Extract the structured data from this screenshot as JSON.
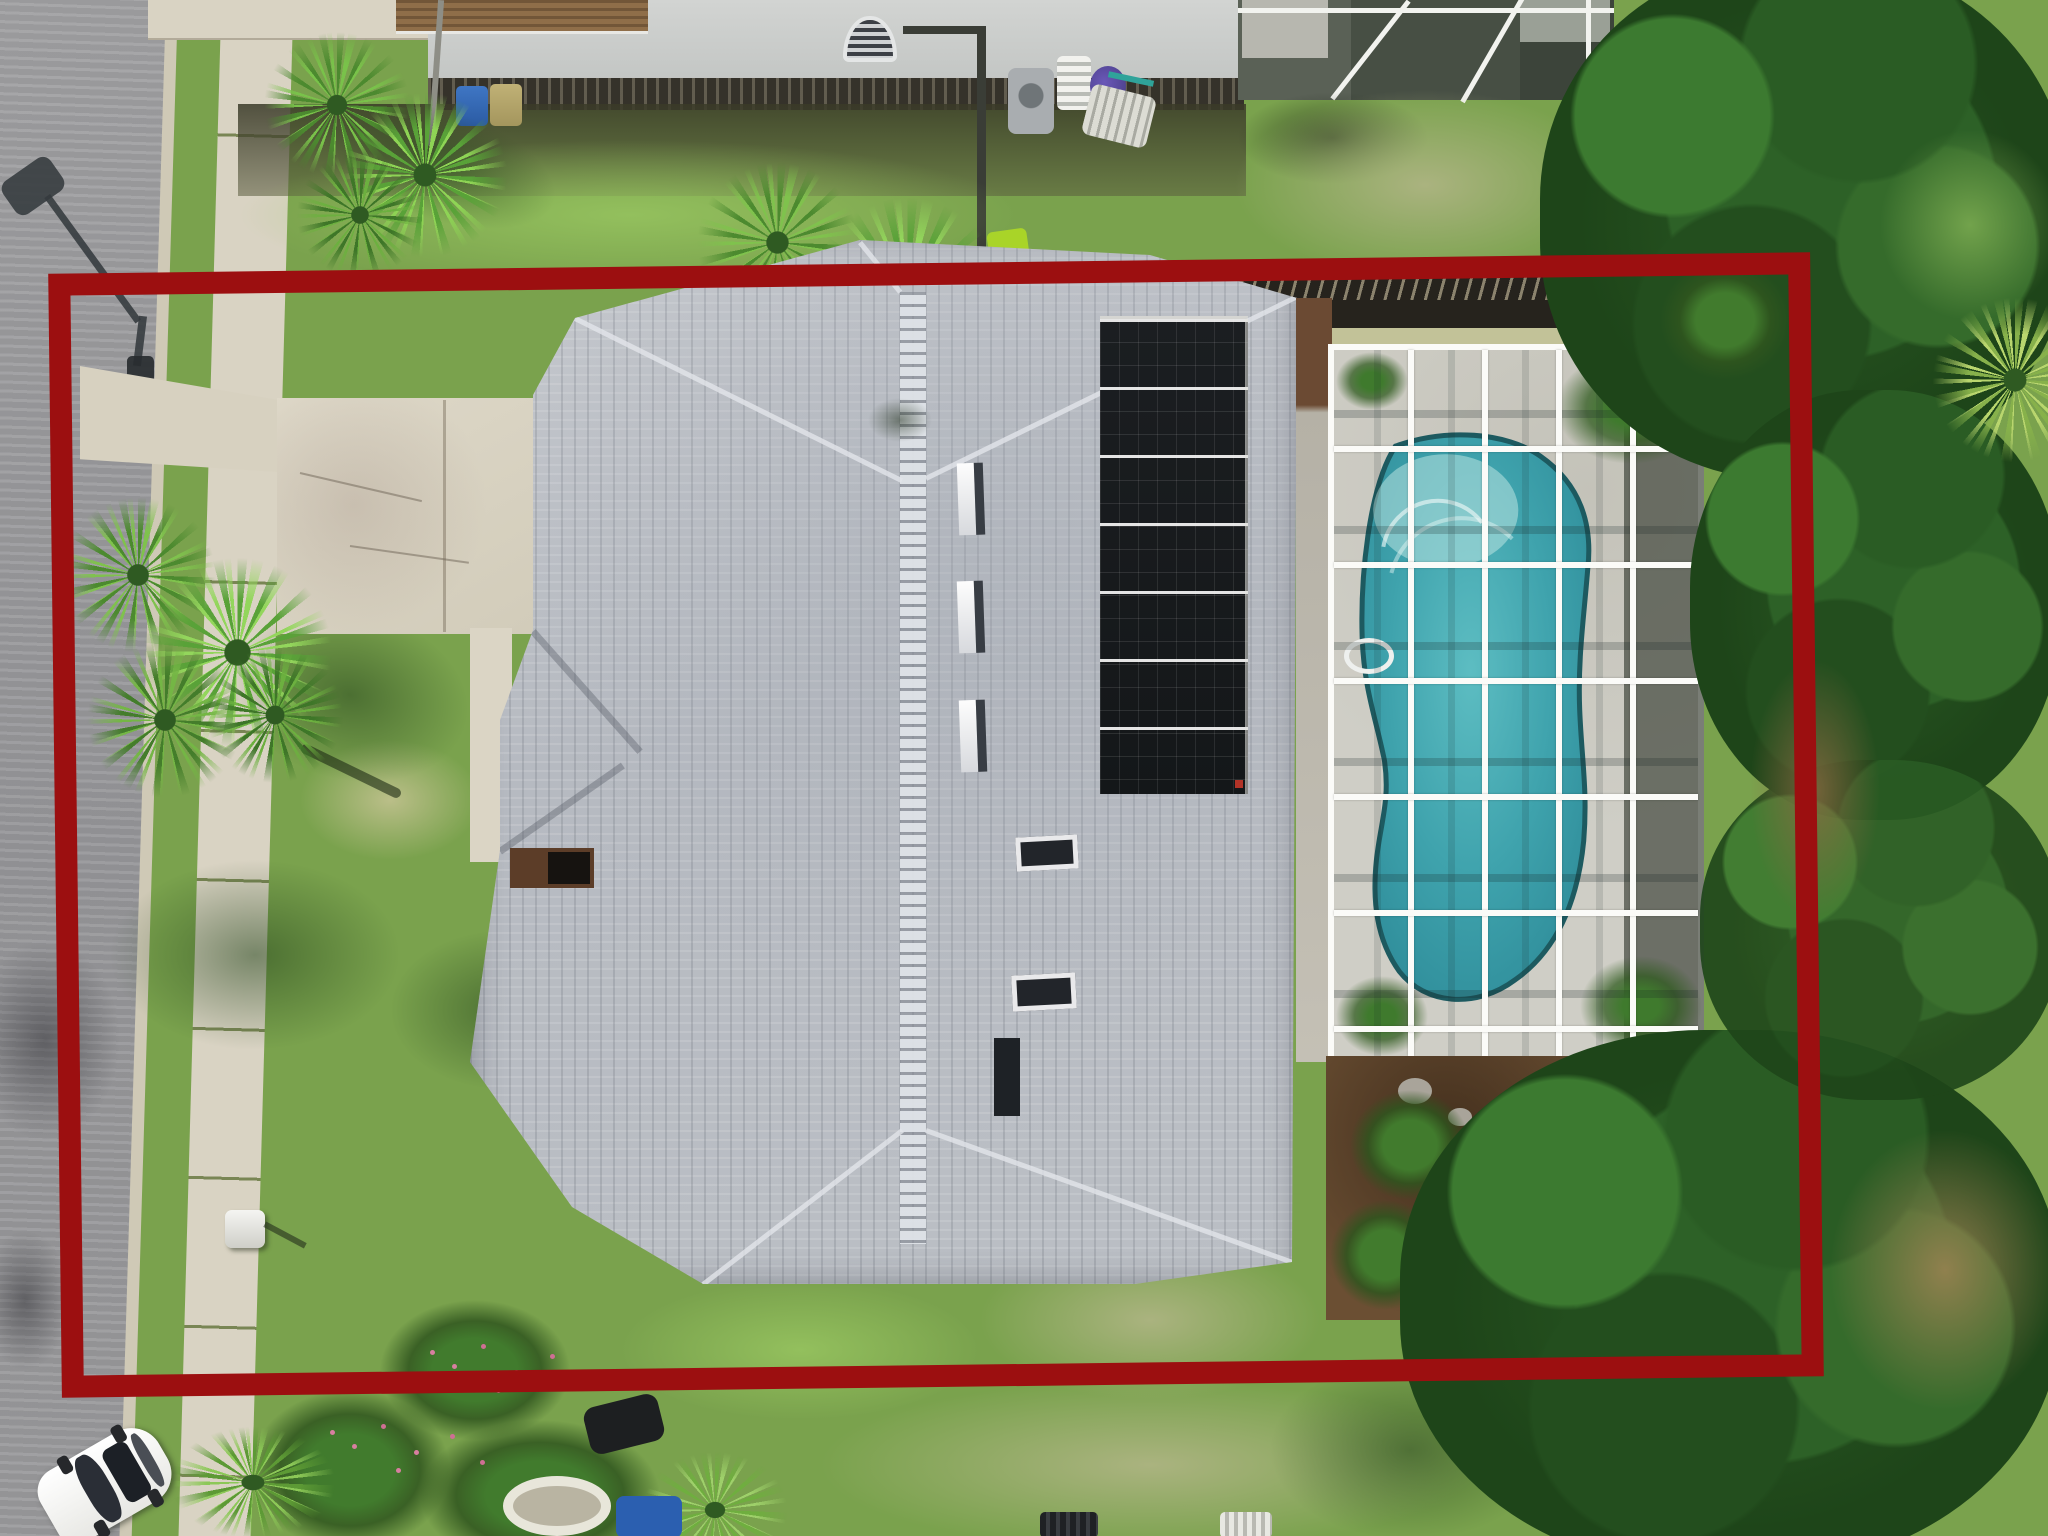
{
  "image": {
    "kind": "aerial-drone-photo",
    "description": "Overhead aerial photograph of a single-family home with gray shingle hip roof, rooftop solar panel array, screened swimming pool enclosure, front driveway and lawn, bordered by a dark red property-boundary outline annotation.",
    "width_px": 2048,
    "height_px": 1536,
    "visible_text": ""
  },
  "annotation": {
    "type": "property-boundary-rectangle",
    "color": "#9C0F10",
    "stroke_px": 22
  },
  "palette": {
    "red_boundary": "#9C0F10",
    "grass": "#7AA24D",
    "grass_dry": "#B9BC8C",
    "curb": "#CFC9B6",
    "sidewalk": "#D9D3C3",
    "pool_deck": "#CFCEC6"
  },
  "objects": {
    "street": "asphalt street",
    "sidewalk": "concrete sidewalk",
    "driveway": "concrete driveway",
    "walkway": "entry walkway",
    "roof": "gray shingle hip roof",
    "solar": "rooftop solar panel array",
    "skylight": "roof skylight",
    "vent": "roof vent",
    "pool_enclosure": "screened pool enclosure",
    "pool": "kidney-shaped swimming pool",
    "handrail": "pool handrail",
    "fence": "backyard wood fence",
    "neighbor_house": "neighboring house",
    "neighbor_enclosure": "neighbor pool enclosure",
    "ac_unit": "air conditioning unit",
    "palm": "palm tree",
    "tree": "tree canopy",
    "bush": "shrub",
    "mulch": "mulch planting bed",
    "mailbox": "mailbox",
    "car": "white car",
    "streetlight": "street light shadow",
    "boundary": "property boundary outline"
  }
}
